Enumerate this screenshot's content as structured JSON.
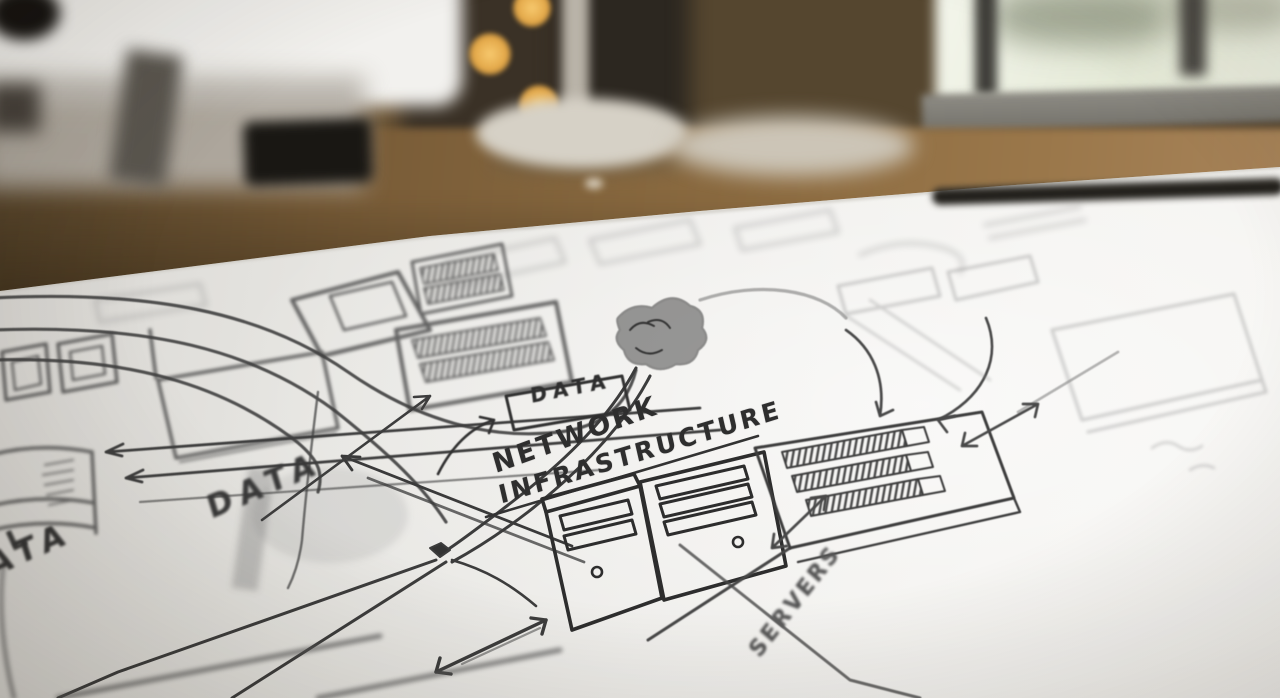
{
  "sketch": {
    "title": {
      "line1": "NETWORK",
      "line2": "INFRASTRUCTURE"
    },
    "labels": {
      "data_box": "DATA",
      "data_handwritten": "DATA",
      "data_partial_prefix": "L",
      "data_partial": "ATA",
      "servers": "SERVERS"
    },
    "icons": {
      "cloud_node": "cloud-node-icon",
      "server_towers": "server-tower-icon",
      "server_rack": "server-rack-icon",
      "database_cylinder": "database-cylinder-icon",
      "data_tables": "data-table-icon",
      "junction": "junction-dot-icon",
      "arrows": "arrow-icon"
    },
    "colors": {
      "pencil": "#3b3b3b",
      "paper": "#f0efec"
    }
  },
  "scene": {
    "colors": {
      "wall": "#3a3126",
      "desk_wood": "#8a6a40",
      "monitor": "#f2f1ee",
      "bokeh_light": "#e2a647",
      "window_glow": "#eef1e3",
      "lamp": "#d6d1c6",
      "speaker": "#191713",
      "pen": "#23211d"
    }
  }
}
